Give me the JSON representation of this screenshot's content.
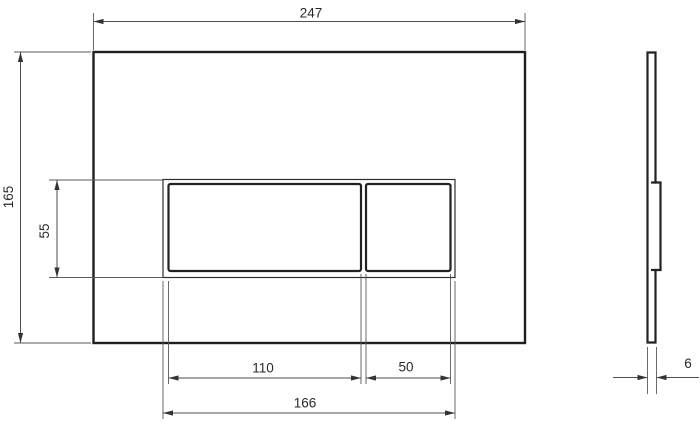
{
  "drawing": {
    "type": "technical-dimension-drawing",
    "views": [
      "front",
      "side"
    ]
  },
  "dimensions": {
    "plate_width": "247",
    "plate_height": "165",
    "button_panel_height": "55",
    "large_button_width": "110",
    "small_button_width": "50",
    "button_panel_width": "166",
    "plate_thickness": "6"
  },
  "colors": {
    "outline": "#1f1f1f",
    "dimension_line": "#4d4d4d",
    "label_text": "#2a2a2a",
    "background": "#ffffff"
  }
}
